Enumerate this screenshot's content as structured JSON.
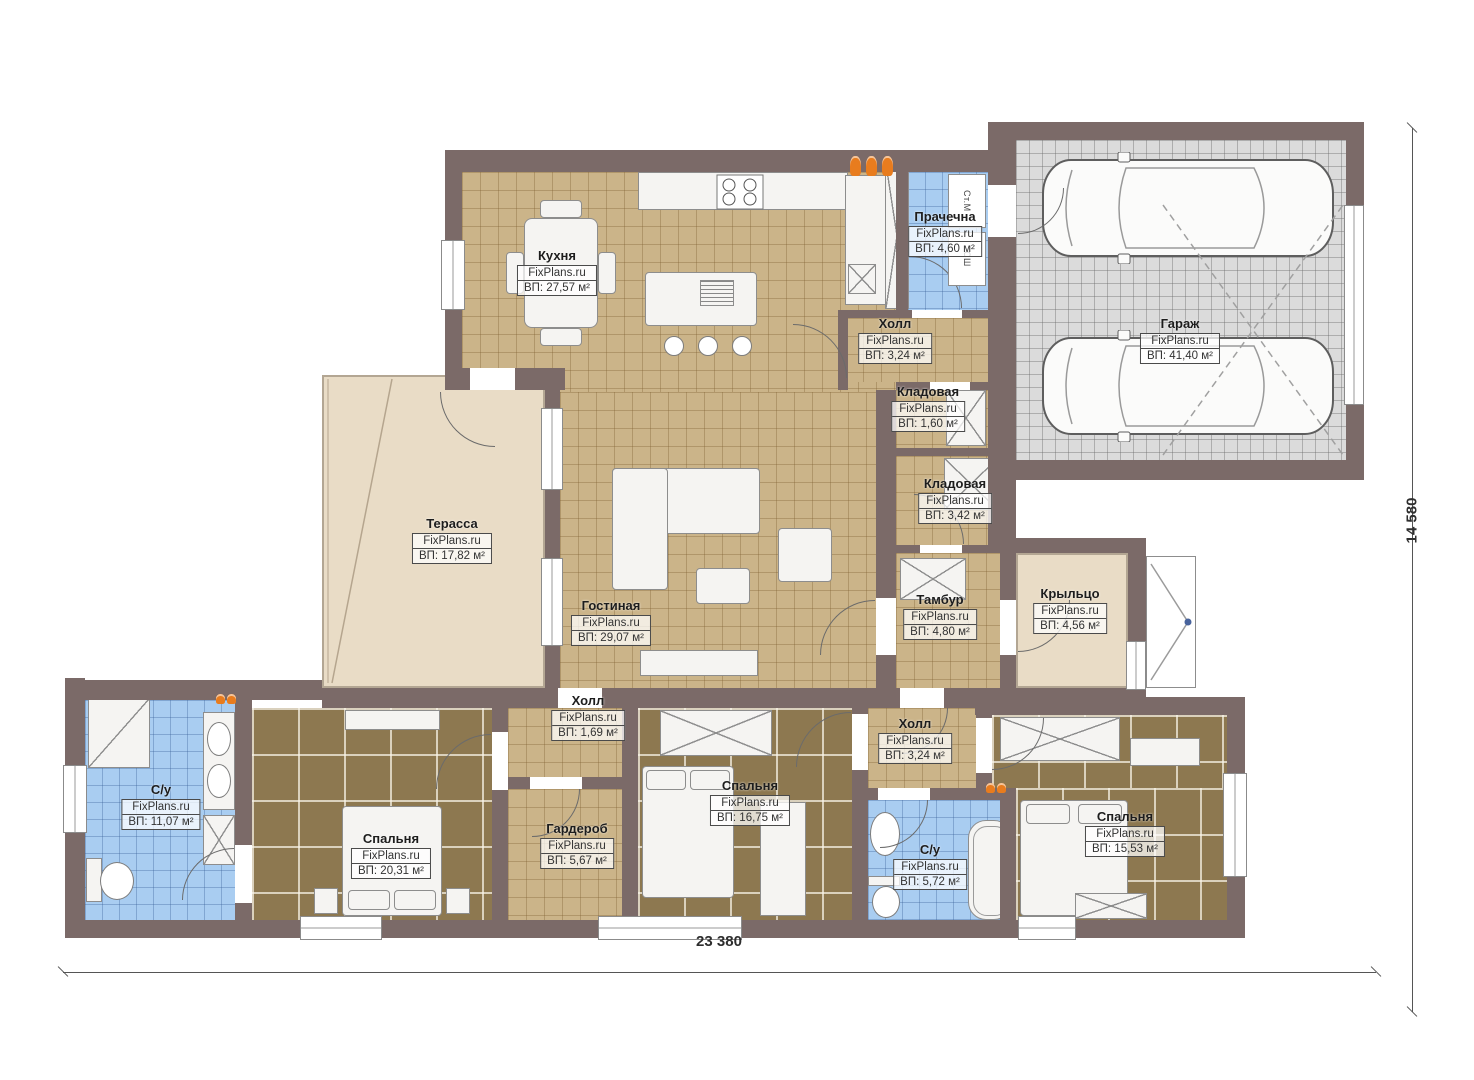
{
  "plan": {
    "type": "house-floor-plan",
    "watermark": "FixPlans.ru",
    "dimensions": {
      "width": "23 380",
      "height": "14 580"
    },
    "appliances": {
      "washer": "Ст.М",
      "dryer": "СШ"
    },
    "colors": {
      "wall": "#7b6a68",
      "floor_tile_tan": "#cbb489",
      "floor_tile_brown": "#8d7850",
      "floor_tile_blue": "#a9cdf1",
      "floor_garage_gray": "#dbdbdb",
      "floor_terrace_beige": "#e9dcc6",
      "accent_orange": "#e87c1e"
    }
  },
  "rooms": {
    "kitchen": {
      "name": "Кухня",
      "watermark": "FixPlans.ru",
      "area": "ВП: 27,57 м²"
    },
    "laundry": {
      "name": "Прачечна",
      "watermark": "FixPlans.ru",
      "area": "ВП: 4,60 м²"
    },
    "hall_top": {
      "name": "Холл",
      "watermark": "FixPlans.ru",
      "area": "ВП: 3,24 м²"
    },
    "pantry_small": {
      "name": "Кладовая",
      "watermark": "FixPlans.ru",
      "area": "ВП: 1,60 м²"
    },
    "garage": {
      "name": "Гараж",
      "watermark": "FixPlans.ru",
      "area": "ВП: 41,40 м²"
    },
    "pantry": {
      "name": "Кладовая",
      "watermark": "FixPlans.ru",
      "area": "ВП: 3,42 м²"
    },
    "tambour": {
      "name": "Тамбур",
      "watermark": "FixPlans.ru",
      "area": "ВП: 4,80 м²"
    },
    "porch": {
      "name": "Крыльцо",
      "watermark": "FixPlans.ru",
      "area": "ВП: 4,56 м²"
    },
    "terrace": {
      "name": "Терасса",
      "watermark": "FixPlans.ru",
      "area": "ВП: 17,82 м²"
    },
    "living": {
      "name": "Гостиная",
      "watermark": "FixPlans.ru",
      "area": "ВП: 29,07 м²"
    },
    "bath_main": {
      "name": "С/у",
      "watermark": "FixPlans.ru",
      "area": "ВП: 11,07 м²"
    },
    "bedroom_1": {
      "name": "Спальня",
      "watermark": "FixPlans.ru",
      "area": "ВП: 20,31 м²"
    },
    "hall_1": {
      "name": "Холл",
      "watermark": "FixPlans.ru",
      "area": "ВП: 1,69 м²"
    },
    "wardrobe": {
      "name": "Гардероб",
      "watermark": "FixPlans.ru",
      "area": "ВП: 5,67 м²"
    },
    "bedroom_2": {
      "name": "Спальня",
      "watermark": "FixPlans.ru",
      "area": "ВП: 16,75 м²"
    },
    "hall_2": {
      "name": "Холл",
      "watermark": "FixPlans.ru",
      "area": "ВП: 3,24 м²"
    },
    "bath_2": {
      "name": "С/у",
      "watermark": "FixPlans.ru",
      "area": "ВП: 5,72 м²"
    },
    "bedroom_3": {
      "name": "Спальня",
      "watermark": "FixPlans.ru",
      "area": "ВП: 15,53 м²"
    }
  }
}
